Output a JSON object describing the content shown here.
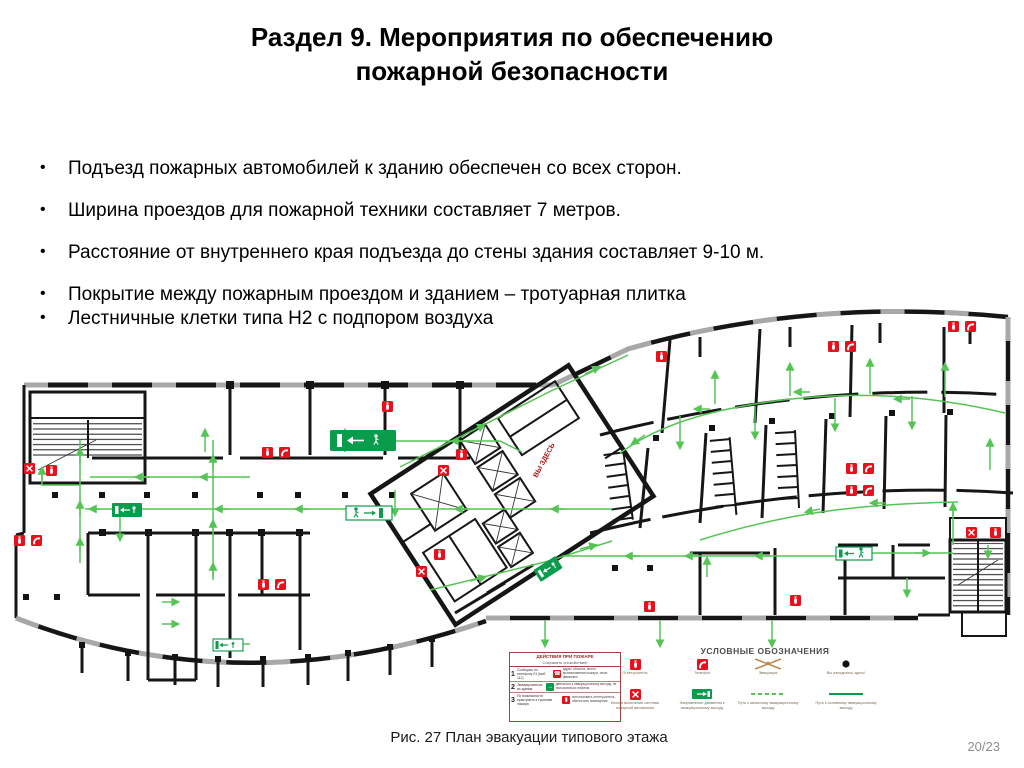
{
  "slide": {
    "title_line1": "Раздел 9. Мероприятия по обеспечению",
    "title_line2": "пожарной безопасности",
    "bullet_char": "•",
    "bullets": [
      "Подъезд пожарных автомобилей к зданию обеспечен со всех сторон.",
      "Ширина проездов для пожарной техники составляет 7 метров.",
      "Расстояние от внутреннего края подъезда до стены здания составляет 9-10 м.",
      "Покрытие между пожарным проездом и зданием – тротуарная плитка",
      "Лестничные клетки типа Н2 с подпором воздуха"
    ],
    "caption": "Рис. 27 План эвакуации типового этажа",
    "page_number": "20/23"
  },
  "plan": {
    "you_are_here_label": "ВЫ ЗДЕСЬ",
    "colors": {
      "wall": "#161616",
      "evacuation_green": "#55c455",
      "sign_green": "#089c4c",
      "alarm_red": "#e8101c",
      "window_gray": "#a8a8a8"
    },
    "legend": {
      "heading": "УСЛОВНЫЕ ОБОЗНАЧЕНИЯ",
      "actions_table": {
        "title": "ДЕЙСТВИЯ ПРИ ПОЖАРЕ",
        "subtitle": "Сохранять спокойствие!",
        "rows": [
          {
            "num": "1",
            "left": "Сообщить по телефону 01 (моб. 112)",
            "right": "адрес объекта, место возникновения пожара, свою фамилию"
          },
          {
            "num": "2",
            "left": "Эвакуироваться из здания",
            "right": "двигаться к эвакуационному выходу, не пользоваться лифтом"
          },
          {
            "num": "3",
            "left": "По возможности приступить к тушению пожара",
            "right": "использовать огнетушитель, обесточить помещение"
          }
        ]
      },
      "items": [
        {
          "label": "Огнетушитель"
        },
        {
          "label": "Телефон"
        },
        {
          "label": "Эвакуация"
        },
        {
          "label": "Вы находитесь здесь!"
        },
        {
          "label": "Кнопка включения системы пожарной автоматики"
        },
        {
          "label": "Направление движения к эвакуационному выходу"
        },
        {
          "label": "Путь к запасному эвакуационному выходу"
        },
        {
          "label": "Путь к основному эвакуационному выходу"
        }
      ]
    }
  }
}
